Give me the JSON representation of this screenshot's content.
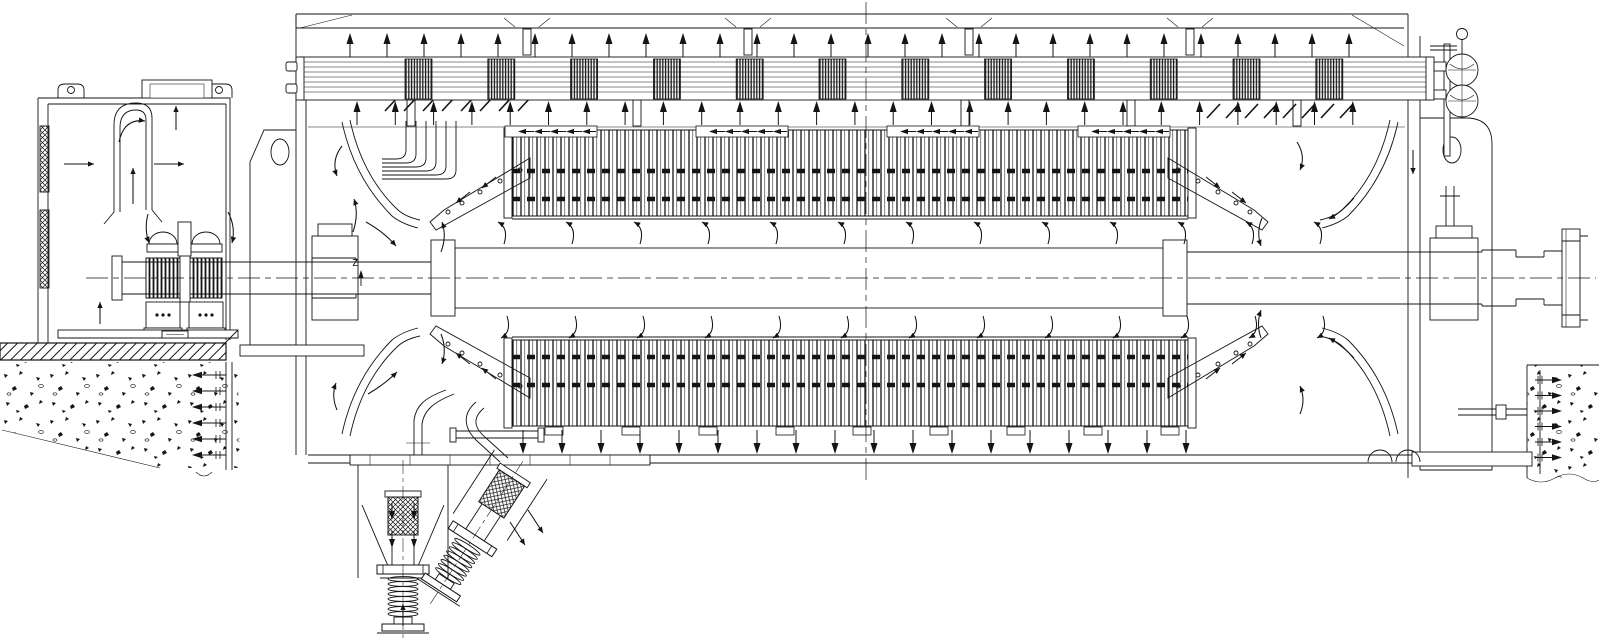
{
  "drawing": {
    "background": "#ffffff",
    "line_color": "#141414",
    "datum_label": "Z"
  },
  "repeated_elements": [
    {
      "name": "cooler-top-airflow-arrow",
      "glyph": "g-arr-up",
      "layer": "lay-arrows",
      "x0": 350,
      "y": 33,
      "pitch": 37,
      "count": 28
    },
    {
      "name": "cooler-bottom-airflow-arrow",
      "glyph": "g-arr-up",
      "layer": "lay-arrows",
      "x0": 357,
      "y": 101,
      "pitch": 38.3,
      "count": 27
    },
    {
      "name": "airgap-upper-flow-arrow",
      "glyph": "g-hook-up",
      "layer": "lay-arrows",
      "x0": 495,
      "y": 218,
      "pitch": 68,
      "count": 13
    },
    {
      "name": "airgap-lower-flow-arrow",
      "glyph": "g-hook-down",
      "layer": "lay-arrows",
      "x0": 498,
      "y": 316,
      "pitch": 68,
      "count": 13
    },
    {
      "name": "outlet-down-arrow",
      "glyph": "g-arr-down",
      "layer": "lay-arrows",
      "x0": 523,
      "y": 430,
      "pitch": 39,
      "count": 18
    },
    {
      "name": "cooler-fin-section",
      "glyph": "g-finblock",
      "layer": "lay-cooler",
      "x0": 405,
      "y": 59,
      "pitch": 82.8,
      "count": 12
    },
    {
      "name": "roof-hanger-tab",
      "glyph": "g-tab",
      "layer": "lay-frame",
      "x0": 523,
      "y": 29,
      "pitch": 221,
      "count": 4
    },
    {
      "name": "plenum-tab",
      "glyph": "g-tab",
      "layer": "lay-frame",
      "x0": 407,
      "y": 100,
      "pitch": 226,
      "count": 2
    },
    {
      "name": "plenum-tab",
      "glyph": "g-tab",
      "layer": "lay-frame",
      "x0": 961,
      "y": 100,
      "pitch": 166,
      "count": 3
    },
    {
      "name": "core-clamp-arrow-strip",
      "glyph": "g-strip",
      "layer": "lay-core",
      "x0": 505,
      "y": 126,
      "pitch": 191,
      "count": 4
    },
    {
      "name": "core-bottom-tab",
      "glyph": "g-tab2",
      "layer": "lay-core",
      "x0": 545,
      "y": 427,
      "pitch": 77,
      "count": 9
    },
    {
      "name": "guide-vane",
      "glyph": "g-vane",
      "layer": "lay-frame",
      "x0": 385,
      "y": 97,
      "pitch": 19,
      "count": 8
    },
    {
      "name": "guide-vane",
      "glyph": "g-vane",
      "layer": "lay-frame",
      "x0": 1207,
      "y": 104,
      "pitch": 19,
      "count": 8
    },
    {
      "name": "anchor-bolt-left",
      "glyph": "g-bolt-left",
      "layer": "lay-foundation",
      "x0": 192,
      "y": 375,
      "dy": 16,
      "count": 6
    },
    {
      "name": "anchor-bolt-right",
      "glyph": "g-bolt-right",
      "layer": "lay-foundation",
      "x0": 1562,
      "y": 380,
      "dy": 15.5,
      "count": 6
    },
    {
      "name": "bushing-duct-arrow",
      "glyph": "g-arr-down-s",
      "layer": "lay-arrows",
      "x0": 392,
      "y": 503,
      "pitch": 22,
      "count": 2
    },
    {
      "name": "bushing-duct-arrow",
      "glyph": "g-arr-down-s",
      "layer": "lay-arrows",
      "x0": 392,
      "y": 531,
      "pitch": 22,
      "count": 2
    }
  ]
}
